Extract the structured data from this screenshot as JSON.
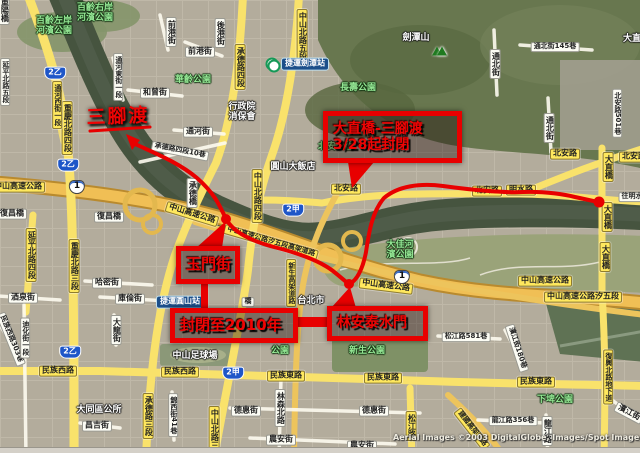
{
  "map": {
    "watermark": {
      "t1": "Aerial Images ©2003 DigitalGlobe, Images/Spot Image, ",
      "t2": "GeoE"
    },
    "colors": {
      "closure_red": "#e80000",
      "highway_yellow": "#f0bf55",
      "road_yellow": "#f9e26b",
      "park_green": "#95e895",
      "river": "#46543f"
    },
    "labels": [
      {
        "t": "中山高速公路",
        "x": 18,
        "y": 187,
        "k": "ry"
      },
      {
        "t": "中山高速公路",
        "x": 192,
        "y": 214,
        "k": "ry",
        "r": 17
      },
      {
        "t": "中山高速公路",
        "x": 386,
        "y": 286,
        "k": "ry",
        "r": 7
      },
      {
        "t": "中山高速公路",
        "x": 545,
        "y": 281,
        "k": "ry"
      },
      {
        "t": "中山高速公路汐五段",
        "x": 583,
        "y": 297,
        "k": "ry",
        "fs": 8
      },
      {
        "t": "中山高速公路汐五段高架道路",
        "x": 271,
        "y": 242,
        "k": "ry",
        "r": 16,
        "fs": 7
      },
      {
        "t": "北安路",
        "x": 346,
        "y": 189,
        "k": "ry"
      },
      {
        "t": "北安路",
        "x": 487,
        "y": 191,
        "k": "ry"
      },
      {
        "t": "北安路",
        "x": 565,
        "y": 154,
        "k": "ry"
      },
      {
        "t": "北安路",
        "x": 634,
        "y": 157,
        "k": "ry"
      },
      {
        "t": "明水路",
        "x": 521,
        "y": 190,
        "k": "ry"
      },
      {
        "t": "承德路四段",
        "x": 240,
        "y": 67,
        "k": "ry",
        "v": 1
      },
      {
        "t": "重慶北路四段",
        "x": 67,
        "y": 128,
        "k": "ry",
        "v": 1
      },
      {
        "t": "重慶北路三段",
        "x": 74,
        "y": 266,
        "k": "ry",
        "v": 1
      },
      {
        "t": "承德路三段",
        "x": 148,
        "y": 416,
        "k": "ry",
        "v": 1
      },
      {
        "t": "延平北路四段",
        "x": 31,
        "y": 255,
        "k": "ry",
        "v": 1
      },
      {
        "t": "中山北路五段",
        "x": 302,
        "y": 36,
        "k": "ry",
        "v": 1
      },
      {
        "t": "中山北路四段",
        "x": 257,
        "y": 196,
        "k": "ry",
        "v": 1
      },
      {
        "t": "中山北路三段",
        "x": 214,
        "y": 433,
        "k": "ry",
        "v": 1
      },
      {
        "t": "民族西路",
        "x": 58,
        "y": 371,
        "k": "ry"
      },
      {
        "t": "民族西路",
        "x": 180,
        "y": 372,
        "k": "ry"
      },
      {
        "t": "民族東路",
        "x": 286,
        "y": 376,
        "k": "ry"
      },
      {
        "t": "民族東路",
        "x": 383,
        "y": 378,
        "k": "ry"
      },
      {
        "t": "民族東路",
        "x": 536,
        "y": 382,
        "k": "ry"
      },
      {
        "t": "通河西街一段",
        "x": 57,
        "y": 105,
        "k": "ry",
        "v": 1,
        "fs": 7
      },
      {
        "t": "松江路",
        "x": 411,
        "y": 426,
        "k": "ry",
        "v": 1
      },
      {
        "t": "建國高架道路",
        "x": 472,
        "y": 429,
        "k": "ry",
        "r": 52,
        "fs": 7
      },
      {
        "t": "復興北路地下道",
        "x": 608,
        "y": 377,
        "k": "ry",
        "v": 1,
        "fs": 7
      },
      {
        "t": "大直橋",
        "x": 608,
        "y": 167,
        "k": "ry",
        "v": 1
      },
      {
        "t": "大直橋",
        "x": 607,
        "y": 217,
        "k": "ry",
        "v": 1
      },
      {
        "t": "大直橋",
        "x": 605,
        "y": 257,
        "k": "ry",
        "v": 1
      },
      {
        "t": "新生高架道路",
        "x": 291,
        "y": 283,
        "k": "ry",
        "v": 1,
        "fs": 7
      },
      {
        "t": "復昌橋",
        "x": 12,
        "y": 214,
        "k": "rw"
      },
      {
        "t": "復昌橋",
        "x": 109,
        "y": 217,
        "k": "rw"
      },
      {
        "t": "承德橋",
        "x": 192,
        "y": 193,
        "k": "rw",
        "v": 1
      },
      {
        "t": "哈密街",
        "x": 107,
        "y": 283,
        "k": "rw"
      },
      {
        "t": "庫倫街",
        "x": 130,
        "y": 299,
        "k": "rw"
      },
      {
        "t": "酒泉街",
        "x": 23,
        "y": 298,
        "k": "rw"
      },
      {
        "t": "通河街",
        "x": 198,
        "y": 132,
        "k": "rw"
      },
      {
        "t": "承德路四段10巷",
        "x": 180,
        "y": 151,
        "k": "rw",
        "r": 11,
        "fs": 7
      },
      {
        "t": "通河東街一段",
        "x": 118,
        "y": 77,
        "k": "rw",
        "v": 1,
        "fs": 7
      },
      {
        "t": "和曾街",
        "x": 155,
        "y": 93,
        "k": "rw"
      },
      {
        "t": "前港街",
        "x": 200,
        "y": 52,
        "k": "rw"
      },
      {
        "t": "前港街",
        "x": 171,
        "y": 32,
        "k": "rw",
        "v": 1
      },
      {
        "t": "後港街",
        "x": 220,
        "y": 33,
        "k": "rw",
        "v": 1
      },
      {
        "t": "通北街145巷",
        "x": 555,
        "y": 47,
        "k": "rw",
        "fs": 7
      },
      {
        "t": "通北街",
        "x": 495,
        "y": 64,
        "k": "rw",
        "v": 1
      },
      {
        "t": "通北街",
        "x": 549,
        "y": 128,
        "k": "rw",
        "v": 1
      },
      {
        "t": "民族西路303巷",
        "x": 11,
        "y": 339,
        "k": "rw",
        "r": 68,
        "fs": 7
      },
      {
        "t": "大龍街",
        "x": 116,
        "y": 330,
        "k": "rw",
        "v": 1
      },
      {
        "t": "錦西街41巷",
        "x": 173,
        "y": 415,
        "k": "rw",
        "v": 1,
        "fs": 7
      },
      {
        "t": "德惠街",
        "x": 246,
        "y": 411,
        "k": "rw"
      },
      {
        "t": "德惠街",
        "x": 374,
        "y": 411,
        "k": "rw"
      },
      {
        "t": "農安街",
        "x": 281,
        "y": 440,
        "k": "rw"
      },
      {
        "t": "農安街",
        "x": 362,
        "y": 446,
        "k": "rw"
      },
      {
        "t": "昌吉街",
        "x": 97,
        "y": 426,
        "k": "rw"
      },
      {
        "t": "松江路581巷",
        "x": 466,
        "y": 337,
        "k": "rw",
        "fs": 7
      },
      {
        "t": "濱江街180巷",
        "x": 517,
        "y": 348,
        "k": "rw",
        "r": 72,
        "fs": 7
      },
      {
        "t": "龍江路356巷",
        "x": 513,
        "y": 421,
        "k": "rw",
        "fs": 7
      },
      {
        "t": "龍江路",
        "x": 547,
        "y": 431,
        "k": "rw",
        "v": 1
      },
      {
        "t": "濱江街",
        "x": 629,
        "y": 413,
        "k": "rw",
        "r": 28
      },
      {
        "t": "往明水",
        "x": 632,
        "y": 197,
        "k": "rw",
        "fs": 7
      },
      {
        "t": "林森北路",
        "x": 280,
        "y": 408,
        "k": "rw",
        "v": 1
      },
      {
        "t": "北安路501巷",
        "x": 617,
        "y": 113,
        "k": "rw",
        "v": 1,
        "fs": 7
      },
      {
        "t": "迪化街一段",
        "x": 25,
        "y": 338,
        "k": "rw",
        "v": 1,
        "fs": 7
      },
      {
        "t": "重陽橋",
        "x": 4,
        "y": 10,
        "k": "rw",
        "v": 1
      },
      {
        "t": "延平北路五段",
        "x": 5,
        "y": 82,
        "k": "rw",
        "v": 1,
        "fs": 7
      },
      {
        "t": "橋",
        "x": 248,
        "y": 302,
        "k": "rw",
        "fs": 7
      },
      {
        "t": "百齡左岸",
        "t2": "河濱公園",
        "x": 54,
        "y": 27,
        "k": "pk"
      },
      {
        "t": "百齡右岸",
        "t2": "河濱公園",
        "x": 95,
        "y": 14,
        "k": "pk"
      },
      {
        "t": "華齡公園",
        "x": 193,
        "y": 81,
        "k": "pk"
      },
      {
        "t": "長壽公園",
        "x": 358,
        "y": 89,
        "k": "pk"
      },
      {
        "t": "北安公園",
        "x": 336,
        "y": 148,
        "k": "pk"
      },
      {
        "t": "大佳河",
        "t2": "濱公園",
        "x": 400,
        "y": 251,
        "k": "pk"
      },
      {
        "t": "新生公園",
        "x": 367,
        "y": 352,
        "k": "pk"
      },
      {
        "t": "下埤公園",
        "x": 555,
        "y": 401,
        "k": "pk"
      },
      {
        "t": "公園",
        "x": 280,
        "y": 352,
        "k": "pk"
      },
      {
        "t": "圓山大飯店",
        "x": 293,
        "y": 168,
        "k": "pl"
      },
      {
        "t": "行政院",
        "t2": "消保會",
        "x": 242,
        "y": 113,
        "k": "pl"
      },
      {
        "t": "大同區公所",
        "x": 99,
        "y": 411,
        "k": "pl"
      },
      {
        "t": "台北市",
        "x": 311,
        "y": 302,
        "k": "pl"
      },
      {
        "t": "大直",
        "x": 632,
        "y": 40,
        "k": "pl"
      },
      {
        "t": "劍潭山",
        "x": 416,
        "y": 39,
        "k": "pl"
      },
      {
        "t": "中山足球場",
        "x": 195,
        "y": 357,
        "k": "pl"
      },
      {
        "t": "捷運劍潭站",
        "x": 305,
        "y": 64,
        "k": "mrt"
      },
      {
        "t": "捷運圓山站",
        "x": 180,
        "y": 302,
        "k": "mrt"
      },
      {
        "t": "1",
        "x": 77,
        "y": 187,
        "k": "sn"
      },
      {
        "t": "1",
        "x": 402,
        "y": 277,
        "k": "sn"
      },
      {
        "t": "2乙",
        "x": 55,
        "y": 73,
        "k": "sp"
      },
      {
        "t": "2乙",
        "x": 68,
        "y": 165,
        "k": "sp"
      },
      {
        "t": "2乙",
        "x": 70,
        "y": 352,
        "k": "sp"
      },
      {
        "t": "2甲",
        "x": 293,
        "y": 210,
        "k": "sp"
      },
      {
        "t": "2甲",
        "x": 233,
        "y": 373,
        "k": "sp"
      },
      {
        "x": 437,
        "y": 51,
        "k": "tri"
      },
      {
        "x": 272,
        "y": 64,
        "k": "mico"
      }
    ]
  },
  "annotations": {
    "hand": {
      "t": "三腳渡",
      "x": 118,
      "y": 117
    },
    "boxes": [
      {
        "x": 323,
        "y": 111,
        "w": 139,
        "h": 52,
        "fs": 14,
        "lines": [
          "大直橋-三腳渡",
          "3/28起封閉"
        ]
      },
      {
        "x": 176,
        "y": 246,
        "w": 64,
        "h": 38,
        "fs": 15,
        "lines": [
          "玉門街"
        ]
      },
      {
        "x": 170,
        "y": 308,
        "w": 128,
        "h": 35,
        "fs": 15,
        "lines": [
          "封閉至2010年"
        ]
      },
      {
        "x": 327,
        "y": 306,
        "w": 101,
        "h": 35,
        "fs": 14,
        "lines": [
          "林安泰水門"
        ]
      }
    ]
  }
}
